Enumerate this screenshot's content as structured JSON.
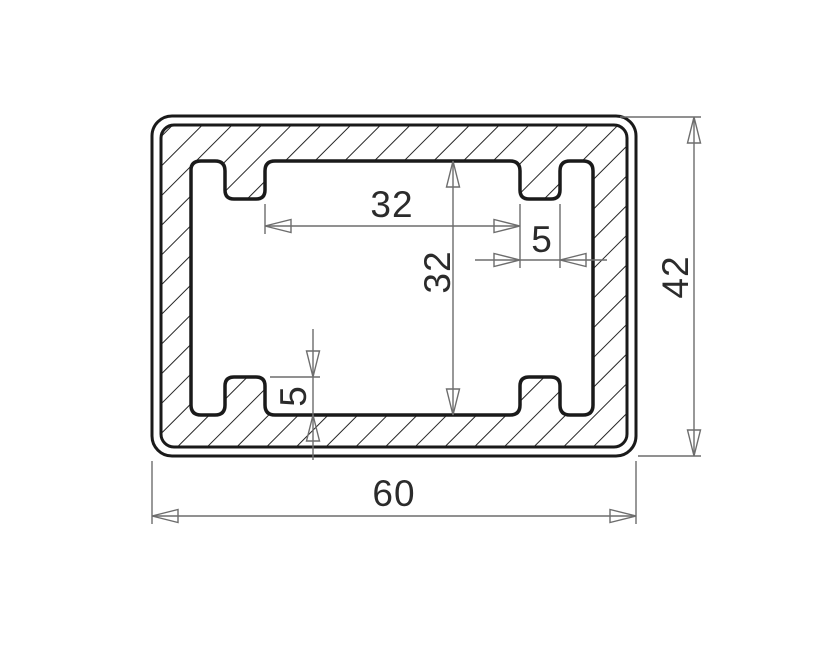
{
  "drawing": {
    "type": "technical cross-section drawing",
    "subject": "rounded rectangular tube profile with four internal ribs, section hatching and linear dimensions",
    "dimensions": {
      "inner_width": {
        "label": "32",
        "orientation": "horizontal",
        "measures": "clear span between top ribs"
      },
      "rib_width": {
        "label": "5",
        "orientation": "horizontal",
        "measures": "top-right rib width"
      },
      "inner_height": {
        "label": "32",
        "orientation": "vertical",
        "measures": "cavity height"
      },
      "rib_height": {
        "label": "5",
        "orientation": "vertical",
        "measures": "bottom-left rib height"
      },
      "outer_width": {
        "label": "60",
        "orientation": "horizontal",
        "measures": "overall profile width"
      },
      "outer_height": {
        "label": "42",
        "orientation": "vertical",
        "measures": "overall profile height"
      }
    },
    "colors": {
      "background": "#ffffff",
      "profile_line": "#1a1a1a",
      "hatch_line": "#262626",
      "dimension_line": "#6d6d6d",
      "dimension_text": "#2b2b2b"
    }
  }
}
